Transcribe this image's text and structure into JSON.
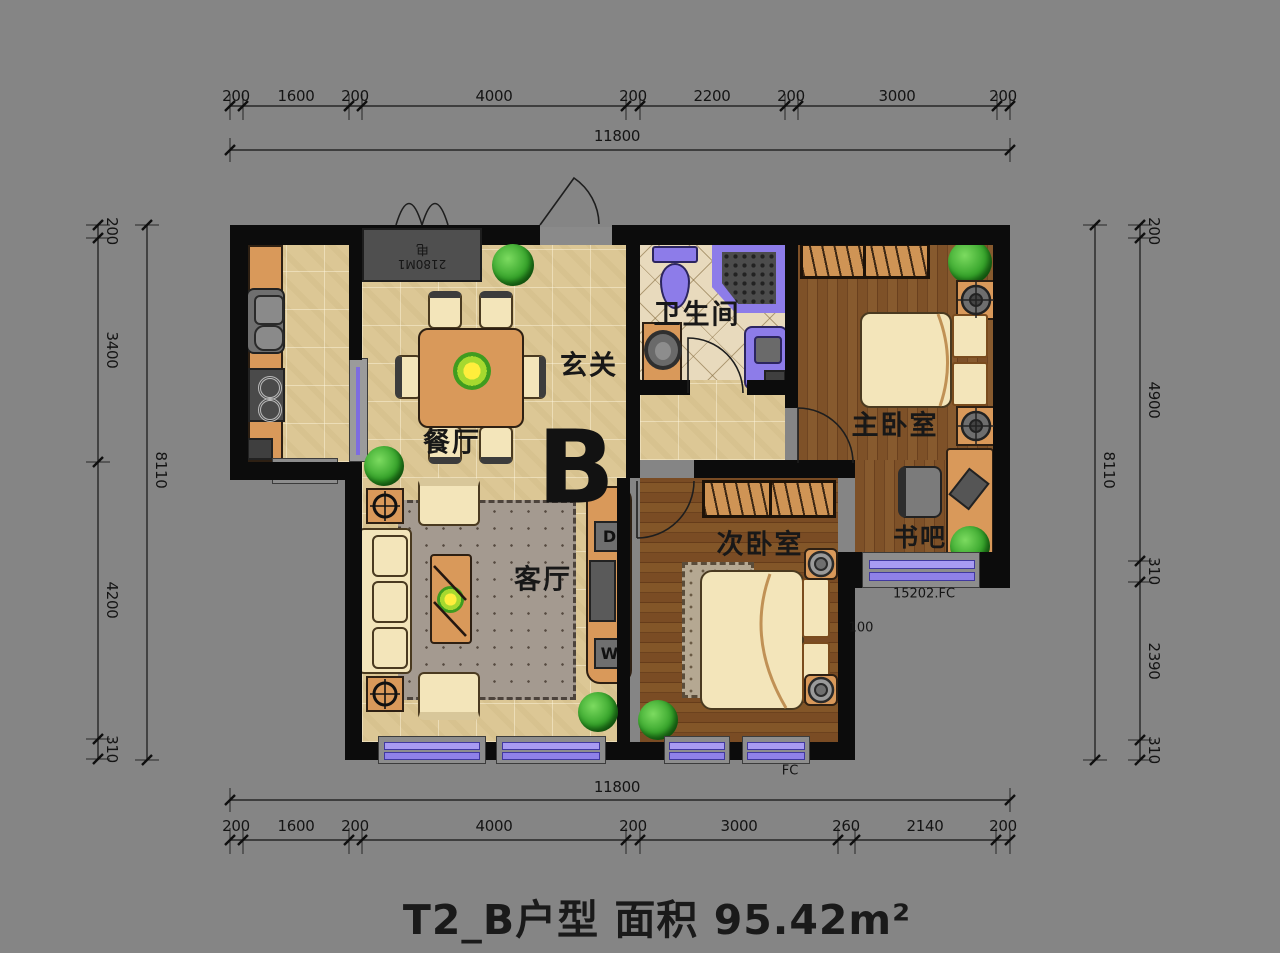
{
  "title": "T2_B户型 面积 95.42m²",
  "plan_letter": "B",
  "rooms": {
    "bathroom": "卫生间",
    "entrance": "玄关",
    "dining": "餐厅",
    "living": "客厅",
    "secondary_bedroom": "次卧室",
    "master_bedroom": "主卧室",
    "book_bar": "书吧"
  },
  "annotations": {
    "d_box": "D",
    "w_box": "W",
    "bay_window_note": "15202.FC",
    "offset_note": "100",
    "fc_note": "FC",
    "elevator_num": "2180M1",
    "elevator_char": "电"
  },
  "dimensions": {
    "top": {
      "total": "11800",
      "segments": [
        "200",
        "1600",
        "200",
        "4000",
        "200",
        "2200",
        "200",
        "3000",
        "200"
      ]
    },
    "bottom": {
      "total": "11800",
      "segments": [
        "200",
        "1600",
        "200",
        "4000",
        "200",
        "3000",
        "260",
        "2140",
        "200"
      ]
    },
    "left": {
      "total": "8110",
      "segments": [
        "200",
        "3400",
        "4200",
        "310"
      ]
    },
    "right": {
      "total": "8110",
      "segments": [
        "200",
        "4900",
        "310",
        "2390",
        "310"
      ]
    }
  },
  "colors": {
    "background": "#858585",
    "wall": "#0c0c0c",
    "tile_floor": "#dcc795",
    "wood_floor": "#7e5128",
    "window_purple": "#8f81e8",
    "fixture_purple": "#8d7ce9",
    "furniture_wood": "#d9995a",
    "cream": "#f3e5ba"
  }
}
